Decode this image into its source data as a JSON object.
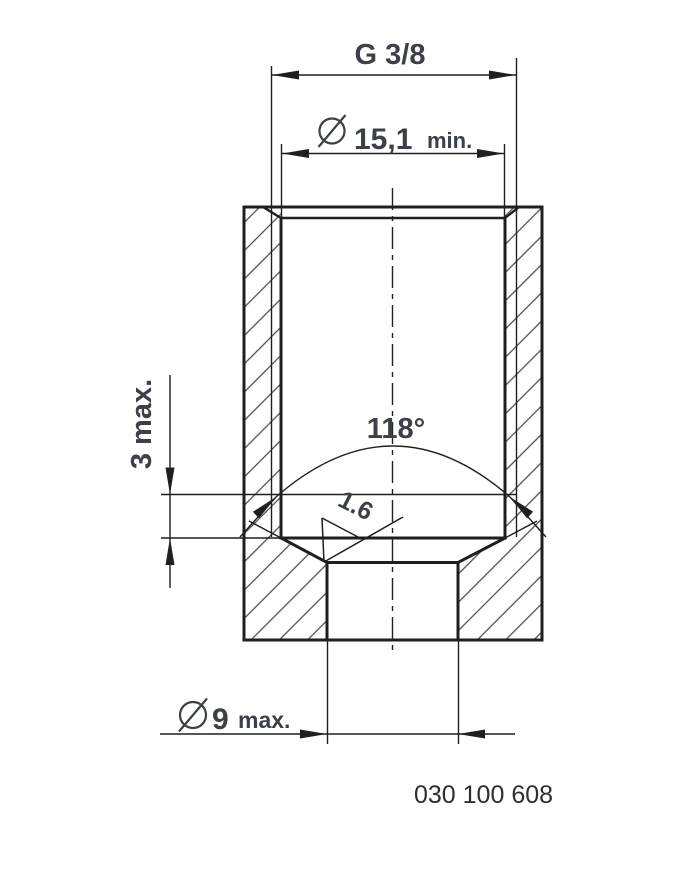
{
  "drawing": {
    "type": "engineering-section-drawing",
    "part_number": "030 100 608",
    "dimensions": {
      "thread": {
        "label": "G 3/8"
      },
      "counterbore": {
        "symbol": "⌀",
        "value": "15,1",
        "qualifier": "min."
      },
      "cone_angle": {
        "label": "118°"
      },
      "surface_roughness": {
        "label": "1.6"
      },
      "depth": {
        "label": "3 max."
      },
      "pilot_hole": {
        "symbol": "⌀",
        "value": "9",
        "qualifier": "max."
      }
    },
    "icons": {
      "diameter_symbol_counterbore": "diameter-icon",
      "diameter_symbol_pilot": "diameter-icon",
      "surface_finish_symbol": "surface-finish-check-icon"
    },
    "colors": {
      "line": "#1f1f1f",
      "text": "#3c4047",
      "hatch": "#4a4a4a",
      "background": "#ffffff"
    }
  }
}
